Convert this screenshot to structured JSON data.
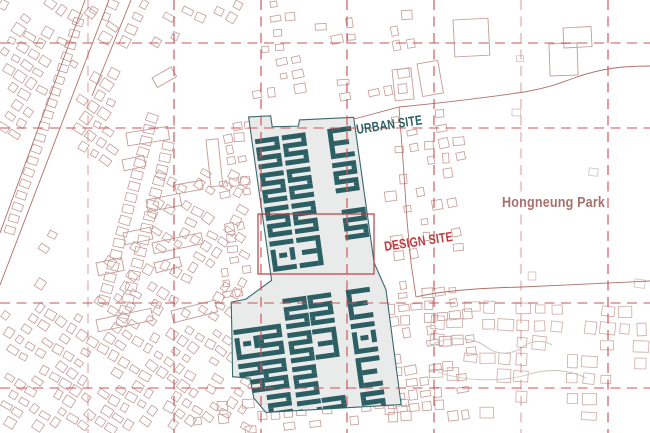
{
  "labels": {
    "urban_site": "URBAN SITE",
    "design_site": "DESIGN SITE",
    "park": "Hongneung Park"
  },
  "colors": {
    "teal": "#2c5f63",
    "site_fill": "#e9eaea",
    "site_outline": "#39696d",
    "grid_red": "#c9575a",
    "design_red": "#c0393f",
    "boundary": "#b0716b",
    "fabric": "#c59b97",
    "fabric_light": "#cfaaa5",
    "fabric_gray": "#cac3bd",
    "park_label": "#a7716e",
    "background": "#ffffff"
  },
  "grid": {
    "vertical_x": [
      88,
      174,
      261,
      347,
      434,
      521,
      608
    ],
    "light_vertical_x": [
      88,
      521
    ],
    "horizontal_y": [
      43,
      128,
      303,
      388
    ],
    "dash": "10 6.5"
  },
  "design_site_rect": {
    "x": 258,
    "y": 214,
    "w": 116,
    "h": 60
  },
  "site": {
    "origin": [
      249,
      127
    ],
    "rotation_deg": -8,
    "outline": [
      [
        1,
        -10
      ],
      [
        23,
        -8
      ],
      [
        23,
        3
      ],
      [
        49,
        6
      ],
      [
        51,
        0
      ],
      [
        105,
        5
      ],
      [
        105,
        152
      ],
      [
        113,
        180
      ],
      [
        112,
        296
      ],
      [
        -23,
        285
      ],
      [
        -33,
        269
      ],
      [
        -34,
        249
      ],
      [
        -51,
        245
      ],
      [
        -47,
        213
      ],
      [
        -42,
        171
      ],
      [
        -27,
        170
      ],
      [
        1,
        155
      ]
    ],
    "module": {
      "w": 24,
      "h": 30.5
    },
    "upper": {
      "cols": [
        4,
        31,
        77
      ],
      "rows": [
        13,
        47.5,
        82,
        116.5
      ],
      "skip": [
        [
          77,
          82
        ],
        [
          77,
          116.5
        ]
      ],
      "extra": [
        [
          80,
          95
        ]
      ]
    },
    "lower": {
      "cols": [
        9,
        34,
        73
      ],
      "rows": [
        175,
        209.5,
        244,
        278.5
      ],
      "skip": [
        [
          34,
          244
        ]
      ]
    },
    "west": {
      "cols": [
        -44,
        -20
      ],
      "rows": [
        199,
        233.5,
        268
      ],
      "skip": [
        [
          -44,
          268
        ]
      ]
    }
  },
  "boundaries": {
    "site_top": "M354,119 L399,107",
    "east": "M399,107 L403,160 L407,220 L411,263 L416,297",
    "south_road": "M416,297 C440,291 480,288 522,287 C565,285 615,283 650,281",
    "park": "M399,107 C440,103 490,97 524,92 C552,87 560,83 574,78 C602,68 624,66 650,66",
    "roads": [
      "M85,0 L0,233",
      "M109,0 L0,285",
      "M131,0 L92,96"
    ]
  }
}
